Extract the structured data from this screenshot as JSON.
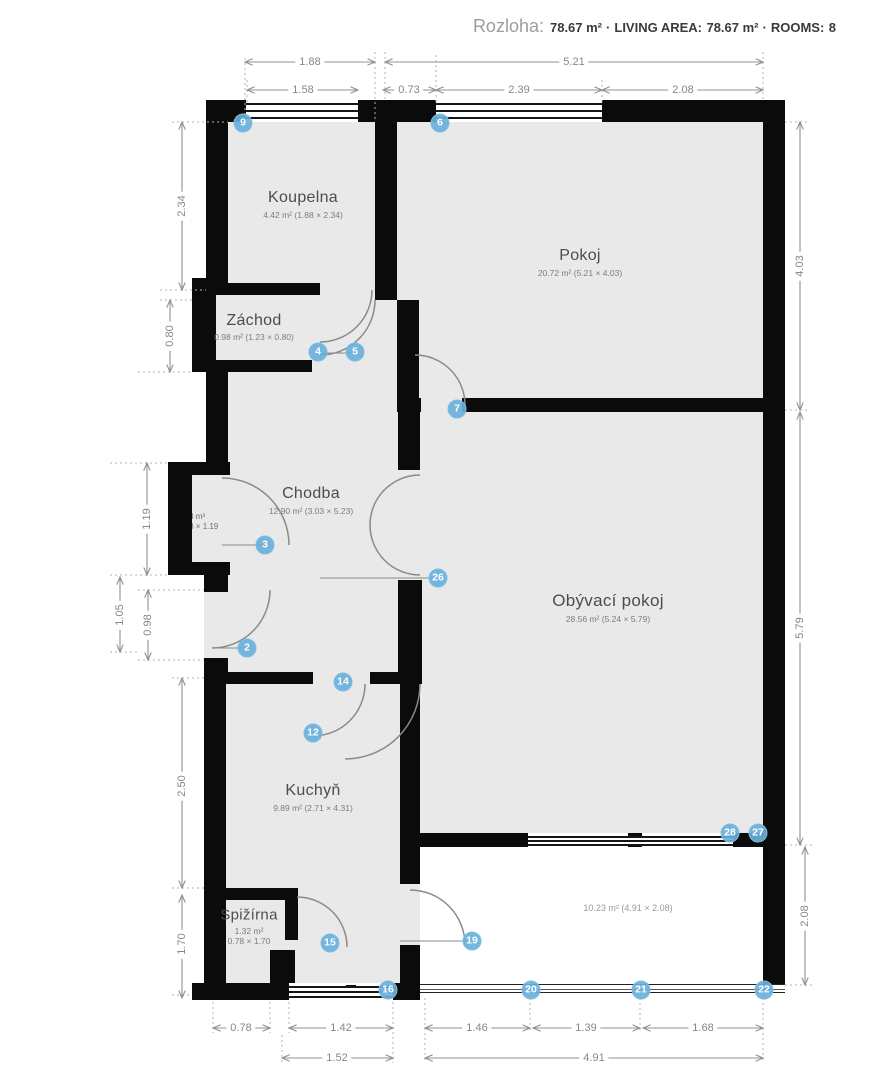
{
  "header": {
    "title": "Rozloha:",
    "area_value": "78.67 m²",
    "living_area_label": "LIVING AREA:",
    "living_area_value": "78.67 m²",
    "rooms_label": "ROOMS:",
    "rooms_value": "8",
    "separator": "·"
  },
  "rooms": [
    {
      "name": "Koupelna",
      "details": "4.42 m² (1.88 × 2.34)"
    },
    {
      "name": "Pokoj",
      "details": "20.72 m² (5.21 × 4.03)"
    },
    {
      "name": "Záchod",
      "details": "0.98 m² (1.23 × 0.80)"
    },
    {
      "name": "Chodba",
      "details": "12.90 m² (3.03 × 5.23)"
    },
    {
      "name": "Obývací pokoj",
      "details": "28.56 m² (5.24 × 5.79)"
    },
    {
      "name": "Kuchyň",
      "details": "9.89 m² (2.71 × 4.31)"
    },
    {
      "name": "Spižírna",
      "details": "1.32 m²",
      "details2": "0.78 × 1.70"
    },
    {
      "name": "",
      "details": "10.23 m² (4.91 × 2.08)"
    }
  ],
  "niche": {
    "area": "0.33 m²",
    "size": "0.28 × 1.19"
  },
  "markers": [
    {
      "n": "9"
    },
    {
      "n": "6"
    },
    {
      "n": "4"
    },
    {
      "n": "5"
    },
    {
      "n": "7"
    },
    {
      "n": "3"
    },
    {
      "n": "26"
    },
    {
      "n": "2"
    },
    {
      "n": "14"
    },
    {
      "n": "12"
    },
    {
      "n": "28"
    },
    {
      "n": "27"
    },
    {
      "n": "15"
    },
    {
      "n": "19"
    },
    {
      "n": "16"
    },
    {
      "n": "20"
    },
    {
      "n": "21"
    },
    {
      "n": "22"
    }
  ],
  "dimensions": {
    "top_row1": [
      "1.88",
      "5.21"
    ],
    "top_row2": [
      "1.58",
      "0.73",
      "2.39",
      "2.08"
    ],
    "left": [
      "2.34",
      "0.80",
      "1.19",
      "1.05",
      "0.98",
      "2.50",
      "1.70"
    ],
    "right": [
      "4.03",
      "5.79",
      "2.08"
    ],
    "bottom_row1": [
      "0.78",
      "1.42",
      "1.46",
      "1.39",
      "1.68"
    ],
    "bottom_row2": [
      "1.52",
      "4.91"
    ]
  },
  "colors": {
    "wall": "#0b0b0b",
    "room_fill": "#e9e9e9",
    "marker": "#68b0da",
    "dimension": "#8a8a8a"
  }
}
